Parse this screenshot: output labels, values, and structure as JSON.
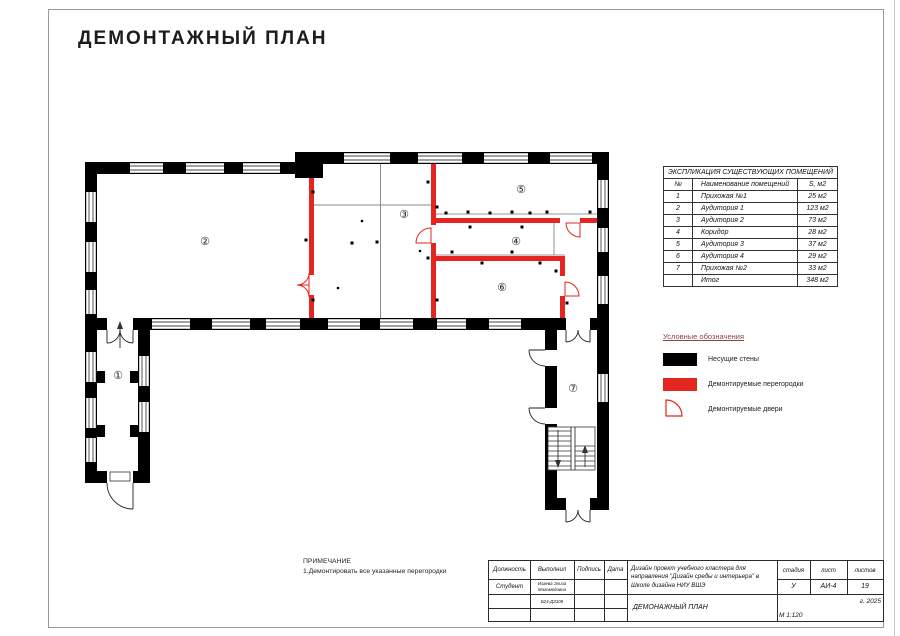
{
  "page": {
    "title": "ДЕМОНТАЖНЫЙ ПЛАН"
  },
  "colors": {
    "demolition_red": "#e42620",
    "wall_black": "#000000",
    "legend_title_text": "#8b4343"
  },
  "plan": {
    "rooms": [
      {
        "number": "1",
        "symbol": "①"
      },
      {
        "number": "2",
        "symbol": "②"
      },
      {
        "number": "3",
        "symbol": "③"
      },
      {
        "number": "4",
        "symbol": "④"
      },
      {
        "number": "5",
        "symbol": "⑤"
      },
      {
        "number": "6",
        "symbol": "⑥"
      },
      {
        "number": "7",
        "symbol": "⑦"
      }
    ]
  },
  "explication_table": {
    "title": "ЭКСПЛИКАЦИЯ СУЩЕСТВУЮЩИХ ПОМЕЩЕНИЙ",
    "columns": [
      "№",
      "Наименование помещений",
      "S, м2"
    ],
    "rows": [
      [
        "1",
        "Прихожая №1",
        "25 м2"
      ],
      [
        "2",
        "Аудитория 1",
        "123 м2"
      ],
      [
        "3",
        "Аудитория 2",
        "73 м2"
      ],
      [
        "4",
        "Коридор",
        "28 м2"
      ],
      [
        "5",
        "Аудитория 3",
        "37 м2"
      ],
      [
        "6",
        "Аудитория 4",
        "29 м2"
      ],
      [
        "7",
        "Прихожая №2",
        "33 м2"
      ],
      [
        "",
        "Итог",
        "348 м2"
      ]
    ]
  },
  "legend": {
    "title": "Условные обозначения",
    "items": [
      {
        "icon": "bearing-wall-swatch",
        "label": "Несущие стены"
      },
      {
        "icon": "demolished-partition-swatch",
        "label": "Демонтируемые  перегородки"
      },
      {
        "icon": "demolished-door-icon",
        "label": "Демонтируемые  двери"
      }
    ]
  },
  "note": {
    "title": "ПРИМЕЧАНИЕ",
    "line1": "1.Демонтировать все указанные перегородки"
  },
  "title_block": {
    "position_header": "Должность",
    "executor_header": "Выполнил",
    "signature_header": "Подпись",
    "date_header": "Дата",
    "position_value": "Студент",
    "executor_name": "Изаева Элиза Магомедовна",
    "group_code": "Б24-ДЗ108",
    "project_description": "Дизайн проект учебного кластера для направления \"Дизайн среды и интерьера\" в Школе дизайна НИУ ВШЭ",
    "stage_header": "стадия",
    "sheet_header": "лист",
    "sheets_header": "листов",
    "stage_value": "У",
    "sheet_value": "АИ-4",
    "sheets_value": "19",
    "year": "г. 2025",
    "drawing_title": "ДЕМОНАЖНЫЙ ПЛАН",
    "scale": "М 1:120"
  }
}
